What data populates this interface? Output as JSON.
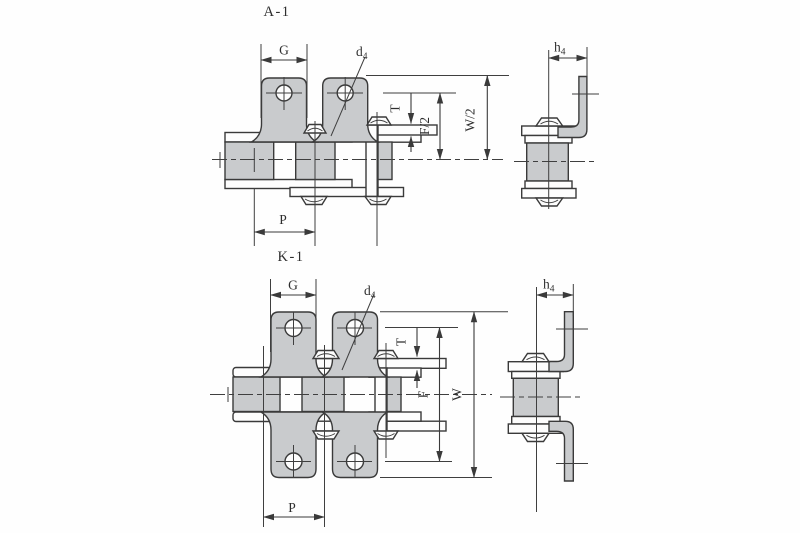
{
  "canvas": {
    "width": 800,
    "height": 533,
    "background": "#fefefe"
  },
  "style": {
    "line_color": "#3a3a3a",
    "fill_color": "#c9cbcd",
    "text_color": "#2e2e2e"
  },
  "views": [
    {
      "id": "a1",
      "title": "A-1",
      "labels": {
        "plate_width": "G",
        "hole_dia_base": "d",
        "hole_dia_sub": "4",
        "plate_thickness": "T",
        "half_inner_width": "F/2",
        "half_overall_width": "W/2",
        "pitch": "P",
        "bend_height_base": "h",
        "bend_height_sub": "4"
      }
    },
    {
      "id": "k1",
      "title": "K-1",
      "labels": {
        "plate_width": "G",
        "hole_dia_base": "d",
        "hole_dia_sub": "4",
        "plate_thickness": "T",
        "inner_width": "F",
        "overall_width": "W",
        "pitch": "P",
        "bend_height_base": "h",
        "bend_height_sub": "4"
      }
    }
  ]
}
